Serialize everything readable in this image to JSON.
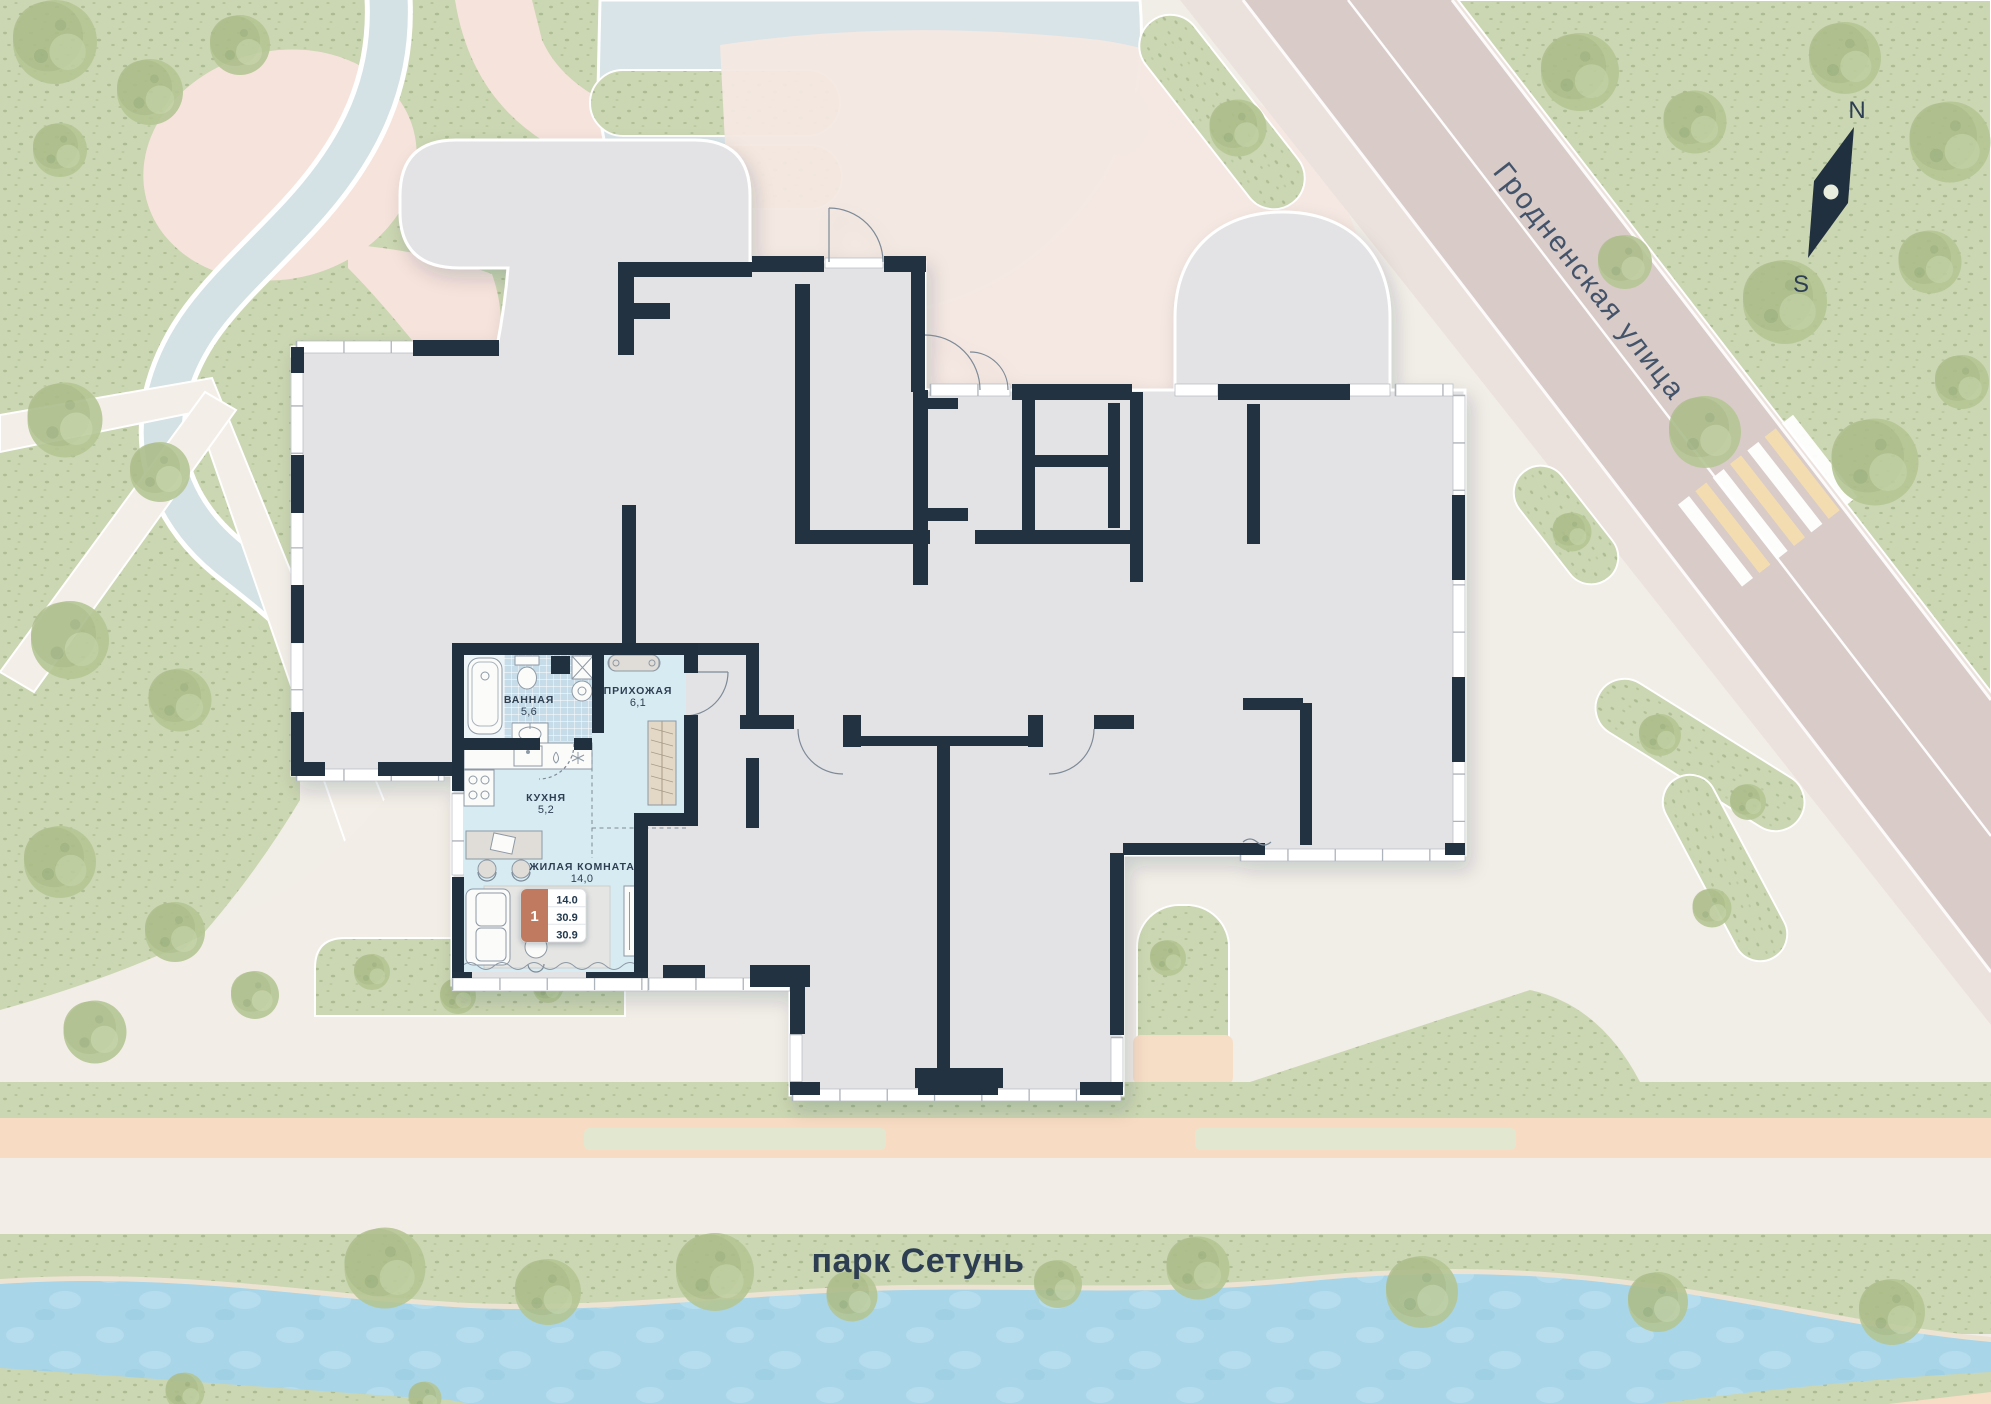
{
  "map": {
    "street_label": "Гродненская улица",
    "park_label": "парк Сетунь",
    "compass": {
      "north": "N",
      "south": "S"
    }
  },
  "apartment": {
    "rooms": [
      {
        "name": "ВАННАЯ",
        "area": "5,6"
      },
      {
        "name": "ПРИХОЖАЯ",
        "area": "6,1"
      },
      {
        "name": "КУХНЯ",
        "area": "5,2"
      },
      {
        "name": "ЖИЛАЯ КОМНАТА",
        "area": "14,0"
      }
    ],
    "badge": {
      "rooms_count": "1",
      "rows": [
        "14.0",
        "30.9",
        "30.9"
      ]
    }
  },
  "colors": {
    "wall": "#20303f",
    "apartment_fill": "#d7ebf3",
    "badge_accent": "#c07a5e",
    "plate_gray": "#e3e3e5",
    "road": "#d8cbc8",
    "park_green": "#cbd6b2",
    "river_blue": "#a9d5e9",
    "text_navy": "#2e3f52"
  }
}
